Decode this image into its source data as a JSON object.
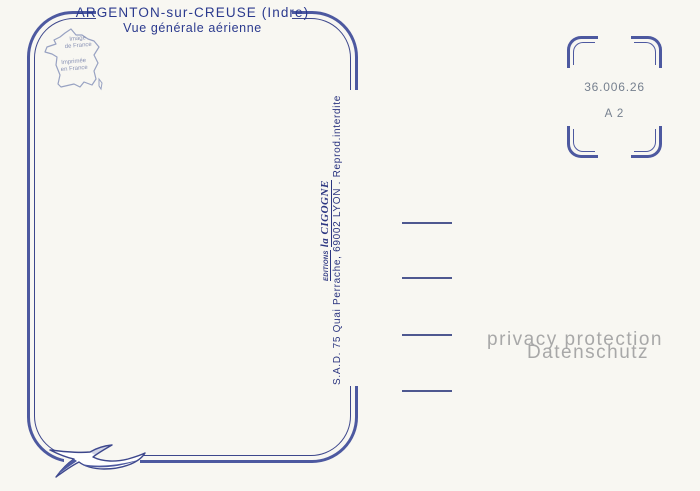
{
  "postcard": {
    "title": {
      "line1": "ARGENTON-sur-CREUSE (Indre)",
      "line2": "Vue générale aérienne"
    },
    "publisher": {
      "imprint": "S.A.D. 75 Quai Perrache, 69002 LYON . Reprod.interdite",
      "logo_prefix": "Editions",
      "logo_name": "la CIGOGNE"
    },
    "stamp_box": {
      "reference": "36.006.26",
      "code": "A 2"
    },
    "map_badge": {
      "line1": "Image",
      "line2": "de France",
      "line3": "Imprimée",
      "line4": "en France"
    },
    "watermark": {
      "line1": "privacy protection",
      "line2": "Datenschutz"
    },
    "colors": {
      "background": "#f8f7f2",
      "border_thick": "#4d59a0",
      "border_thin": "#3d478c",
      "title_text": "#2b3a8e",
      "publisher_text": "#2b3580",
      "stamp_text": "#76808f",
      "watermark_text": "#a8a8a8",
      "map_outline": "#98a2c2"
    },
    "icons": {
      "map": "france-map-outline-icon",
      "bird": "stork-logo-icon"
    }
  }
}
